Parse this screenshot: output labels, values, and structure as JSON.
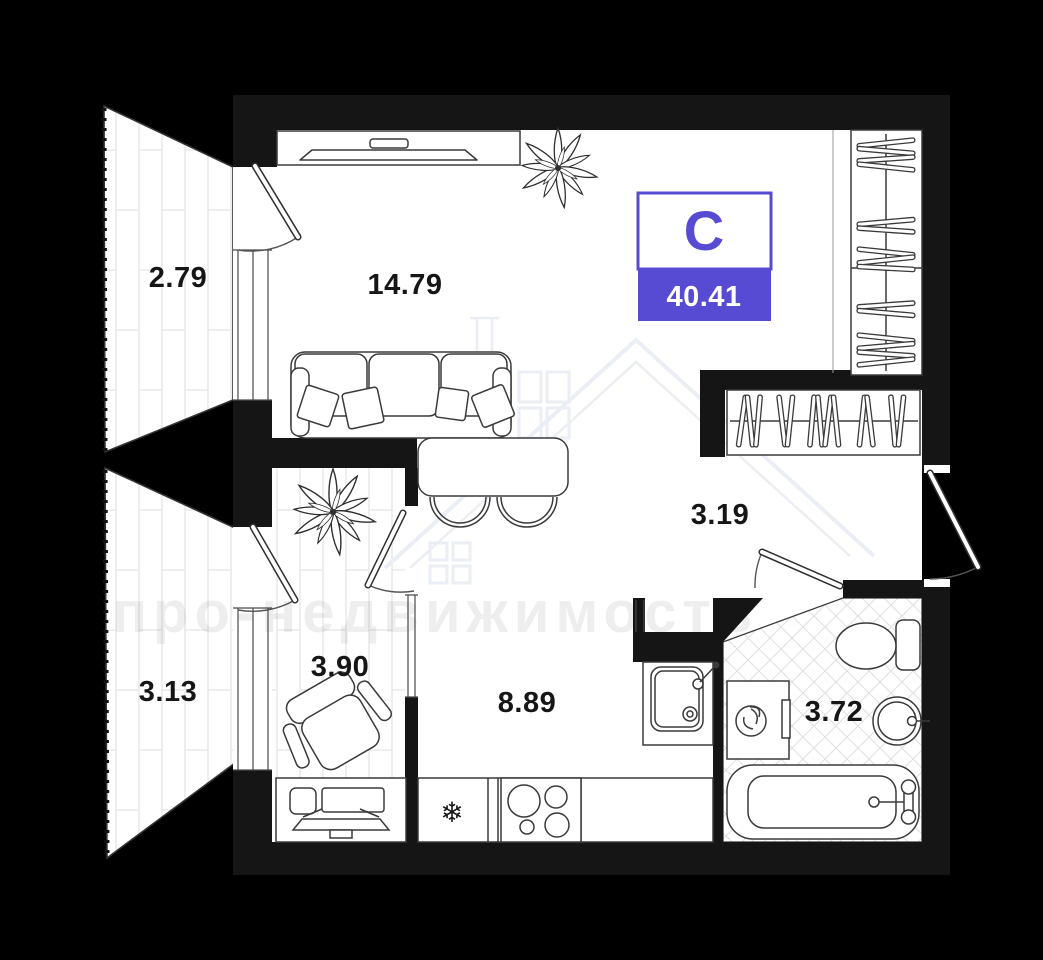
{
  "plan": {
    "badge": {
      "room_type_letter": "С",
      "total_area": "40.41"
    },
    "rooms": [
      {
        "key": "balcony_top",
        "area": "2.79"
      },
      {
        "key": "living_room",
        "area": "14.79"
      },
      {
        "key": "hallway",
        "area": "3.19"
      },
      {
        "key": "balcony_bottom",
        "area": "3.13"
      },
      {
        "key": "cabinet",
        "area": "3.90"
      },
      {
        "key": "kitchen",
        "area": "8.89"
      },
      {
        "key": "bathroom",
        "area": "3.72"
      }
    ],
    "watermark": {
      "text": "про-недвижимость"
    },
    "icons": {
      "fridge_snowflake": "❄"
    },
    "colors": {
      "accent": "#574bd3",
      "walls": "#151515",
      "background": "#000000",
      "floor": "#ffffff",
      "pattern_line": "#e4e4e4"
    }
  }
}
